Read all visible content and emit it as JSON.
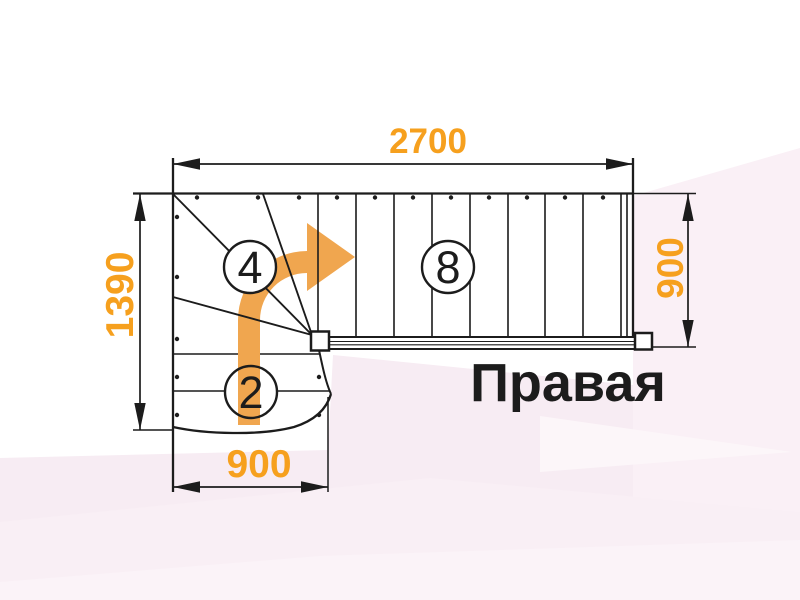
{
  "diagram": {
    "type": "staircase-plan",
    "dimension_top": "2700",
    "dimension_left": "1390",
    "dimension_right": "900",
    "dimension_bottom": "900",
    "label_winder_steps": "4",
    "label_upper_flight_steps": "8",
    "label_lower_flight_steps": "2",
    "caption": "Правая",
    "colors": {
      "dimension_text": "#F6A01E",
      "arrow": "#F0A64F",
      "line": "#1C1C1C",
      "background_tint": "#F7ECF3"
    }
  }
}
